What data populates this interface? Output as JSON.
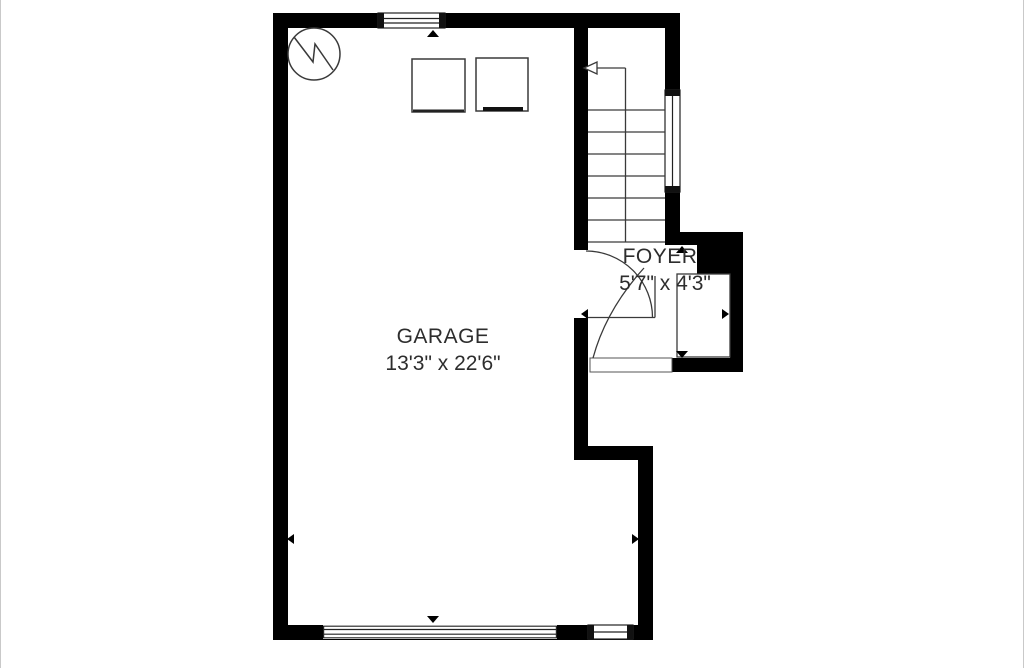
{
  "canvas": {
    "width": 1024,
    "height": 668,
    "background": "#ffffff"
  },
  "colors": {
    "wall": "#000000",
    "line": "#3a3a3a",
    "text": "#2d2d2d",
    "page_edge": "#c9c9c9"
  },
  "rooms": {
    "garage": {
      "name": "GARAGE",
      "dims": "13'3\" x 22'6\""
    },
    "foyer": {
      "name": "FOYER",
      "dims": "5'7\" x 4'3\""
    }
  },
  "symbols": {
    "water_heater_icon": "circle-with-zigzag",
    "washer_icon": "square-outline",
    "dryer_icon": "square-outline-bottom-bar",
    "stairs": {
      "treads": 7,
      "direction_arrow": "left"
    },
    "windows": [
      "top-wall-window",
      "stairwell-window",
      "front-wall-window"
    ],
    "doors": [
      "garage-to-foyer-swing-door",
      "front-entry-door",
      "garage-overhead-door"
    ]
  }
}
